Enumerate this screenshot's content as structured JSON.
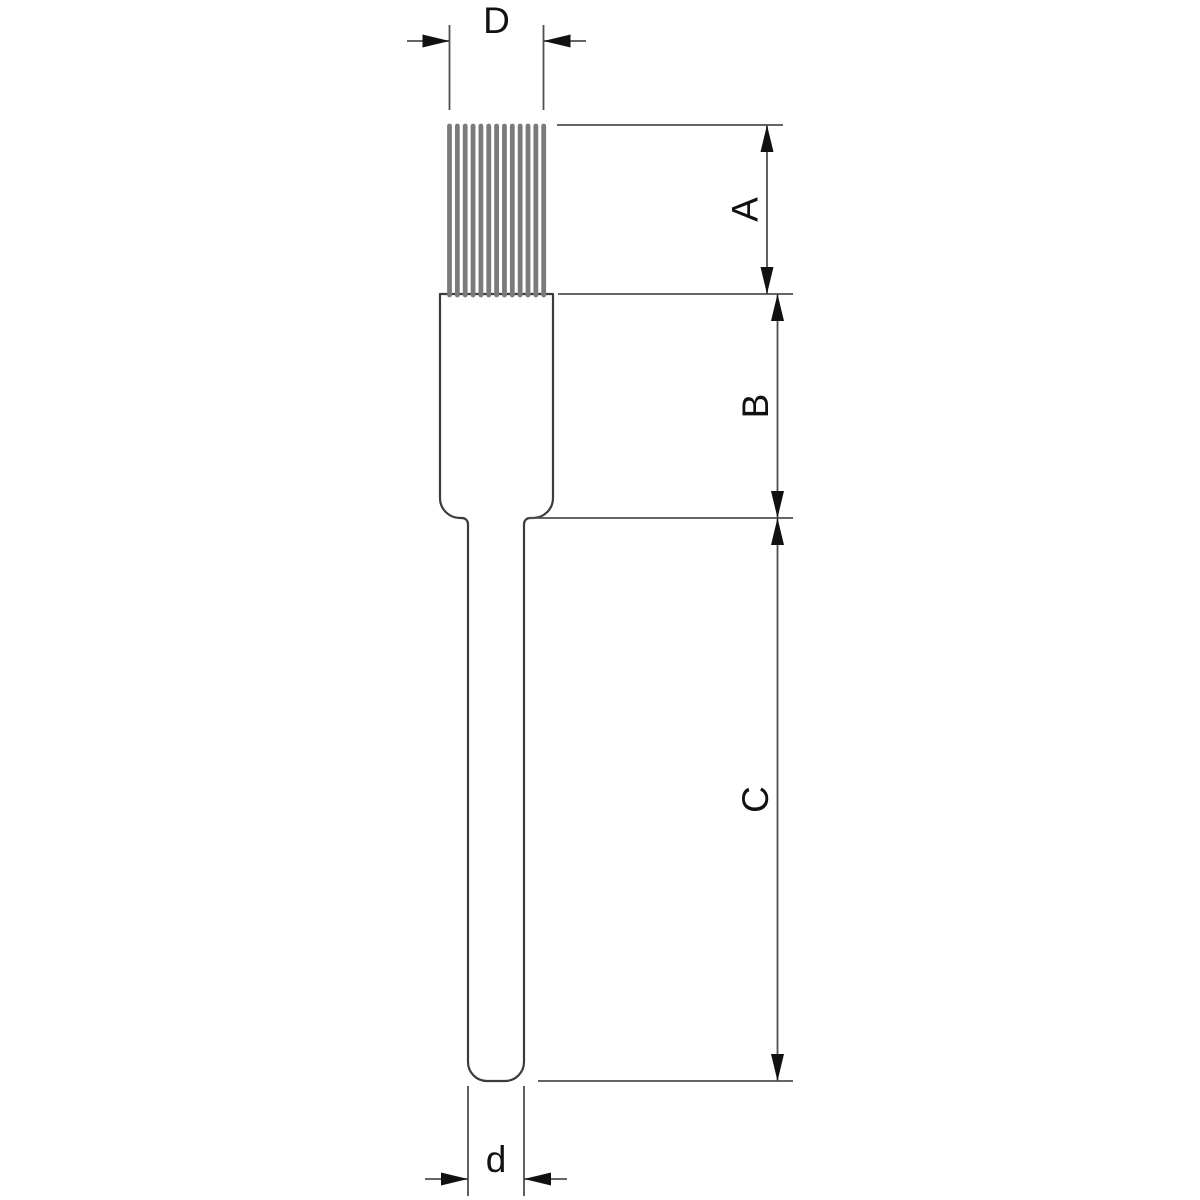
{
  "dimensions": {
    "D": {
      "label": "D"
    },
    "A": {
      "label": "A"
    },
    "B": {
      "label": "B"
    },
    "C": {
      "label": "C"
    },
    "d": {
      "label": "d"
    }
  },
  "object": {
    "bristles": {
      "count": 13
    }
  },
  "colors": {
    "background": "#ffffff",
    "outline": "#3c3c3c",
    "dimension_line": "#4f4f4f",
    "arrow": "#111111",
    "label_text": "#111111",
    "bristle": "#7b7b7b"
  }
}
